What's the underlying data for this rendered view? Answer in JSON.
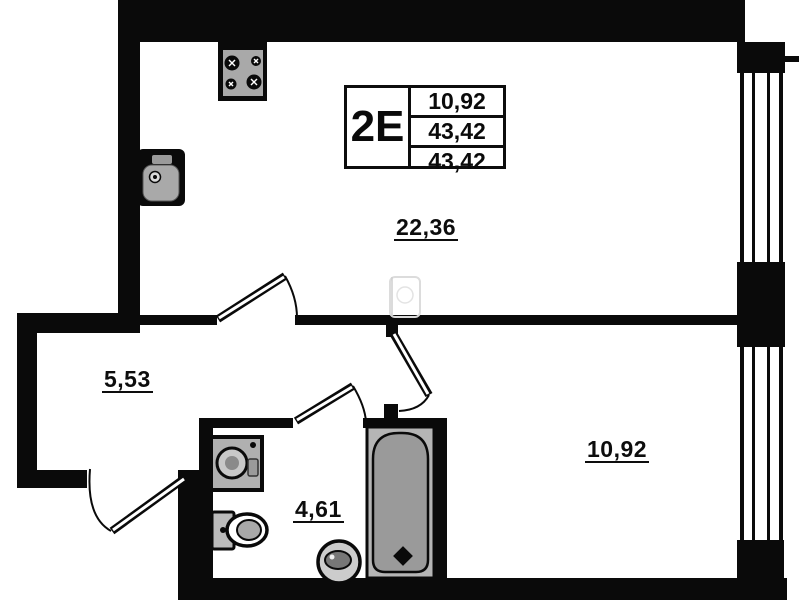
{
  "document": {
    "type": "apartment-floor-plan"
  },
  "title_block": {
    "unit_label": "2E",
    "area_rows": [
      "10,92",
      "43,42",
      "43,42"
    ]
  },
  "rooms": [
    {
      "id": "living-kitchen",
      "area_label": "22,36"
    },
    {
      "id": "hallway",
      "area_label": "5,53"
    },
    {
      "id": "bathroom",
      "area_label": "4,61"
    },
    {
      "id": "bedroom",
      "area_label": "10,92"
    }
  ],
  "fixtures": [
    "stove-4-burner",
    "kitchen-sink",
    "washing-machine",
    "toilet",
    "floor-drain",
    "bathtub",
    "entry-door",
    "living-room-door",
    "bedroom-door",
    "bathroom-door",
    "window-living",
    "window-bedroom",
    "ghost-fixture"
  ],
  "colors": {
    "walls": "#0a0a0a",
    "fixture_gray": "#a9a9a9",
    "tub_gray": "#9a9a9a",
    "background": "#ffffff",
    "faint": "#d9d9d9"
  }
}
